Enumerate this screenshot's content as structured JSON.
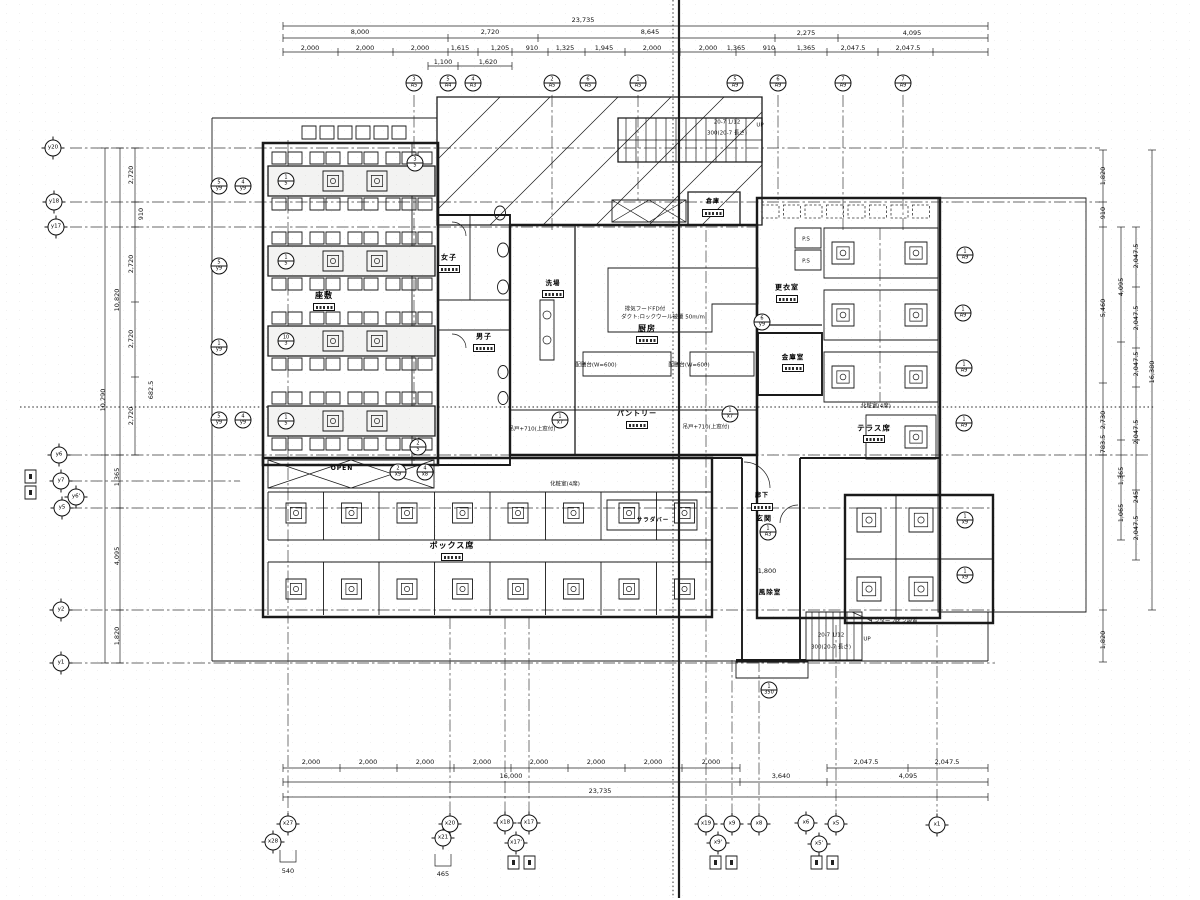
{
  "page": {
    "background": "#ffffff",
    "ink": "#1a1a1a"
  },
  "dimensions": {
    "top": [
      {
        "x": 583,
        "y": 20,
        "t": "23,735"
      },
      {
        "x": 360,
        "y": 32,
        "t": "8,000"
      },
      {
        "x": 490,
        "y": 32,
        "t": "2,720"
      },
      {
        "x": 650,
        "y": 32,
        "t": "8,645"
      },
      {
        "x": 806,
        "y": 33,
        "t": "2,275"
      },
      {
        "x": 912,
        "y": 33,
        "t": "4,095"
      },
      {
        "x": 310,
        "y": 48,
        "t": "2,000"
      },
      {
        "x": 365,
        "y": 48,
        "t": "2,000"
      },
      {
        "x": 420,
        "y": 48,
        "t": "2,000"
      },
      {
        "x": 460,
        "y": 48,
        "t": "1,615"
      },
      {
        "x": 500,
        "y": 48,
        "t": "1,205"
      },
      {
        "x": 532,
        "y": 48,
        "t": "910"
      },
      {
        "x": 565,
        "y": 48,
        "t": "1,325"
      },
      {
        "x": 604,
        "y": 48,
        "t": "1,945"
      },
      {
        "x": 652,
        "y": 48,
        "t": "2,000"
      },
      {
        "x": 708,
        "y": 48,
        "t": "2,000"
      },
      {
        "x": 736,
        "y": 48,
        "t": "1,365"
      },
      {
        "x": 769,
        "y": 48,
        "t": "910"
      },
      {
        "x": 806,
        "y": 48,
        "t": "1,365"
      },
      {
        "x": 853,
        "y": 48,
        "t": "2,047.5"
      },
      {
        "x": 908,
        "y": 48,
        "t": "2,047.5"
      },
      {
        "x": 443,
        "y": 62,
        "t": "1,100"
      },
      {
        "x": 488,
        "y": 62,
        "t": "1,620"
      }
    ],
    "bottom": [
      {
        "x": 311,
        "y": 762,
        "t": "2,000"
      },
      {
        "x": 368,
        "y": 762,
        "t": "2,000"
      },
      {
        "x": 425,
        "y": 762,
        "t": "2,000"
      },
      {
        "x": 482,
        "y": 762,
        "t": "2,000"
      },
      {
        "x": 539,
        "y": 762,
        "t": "2,000"
      },
      {
        "x": 596,
        "y": 762,
        "t": "2,000"
      },
      {
        "x": 653,
        "y": 762,
        "t": "2,000"
      },
      {
        "x": 711,
        "y": 762,
        "t": "2,000"
      },
      {
        "x": 866,
        "y": 762,
        "t": "2,047.5"
      },
      {
        "x": 947,
        "y": 762,
        "t": "2,047.5"
      },
      {
        "x": 511,
        "y": 776,
        "t": "16,000"
      },
      {
        "x": 781,
        "y": 776,
        "t": "3,640"
      },
      {
        "x": 908,
        "y": 776,
        "t": "4,095"
      },
      {
        "x": 600,
        "y": 791,
        "t": "23,735"
      }
    ],
    "left": [
      {
        "x": 131,
        "y": 175,
        "t": "2,720",
        "r": 1
      },
      {
        "x": 141,
        "y": 214,
        "t": "910",
        "r": 1
      },
      {
        "x": 131,
        "y": 264,
        "t": "2,720",
        "r": 1
      },
      {
        "x": 131,
        "y": 339,
        "t": "2,720",
        "r": 1
      },
      {
        "x": 131,
        "y": 416,
        "t": "2,720",
        "r": 1
      },
      {
        "x": 117,
        "y": 300,
        "t": "10,820",
        "r": 1
      },
      {
        "x": 103,
        "y": 400,
        "t": "10,290",
        "r": 1
      },
      {
        "x": 151,
        "y": 390,
        "t": "682.5",
        "r": 1
      },
      {
        "x": 117,
        "y": 477,
        "t": "1,365",
        "r": 1
      },
      {
        "x": 117,
        "y": 556,
        "t": "4,095",
        "r": 1
      },
      {
        "x": 117,
        "y": 636,
        "t": "1,820",
        "r": 1
      }
    ],
    "right": [
      {
        "x": 1103,
        "y": 176,
        "t": "1,820",
        "r": 1
      },
      {
        "x": 1103,
        "y": 213,
        "t": "910",
        "r": 1
      },
      {
        "x": 1103,
        "y": 308,
        "t": "5,460",
        "r": 1
      },
      {
        "x": 1103,
        "y": 420,
        "t": "2,730",
        "r": 1
      },
      {
        "x": 1121,
        "y": 287,
        "t": "4,095",
        "r": 1
      },
      {
        "x": 1136,
        "y": 256,
        "t": "2,047.5",
        "r": 1
      },
      {
        "x": 1136,
        "y": 318,
        "t": "2,047.5",
        "r": 1
      },
      {
        "x": 1136,
        "y": 364,
        "t": "2,047.5",
        "r": 1
      },
      {
        "x": 1152,
        "y": 372,
        "t": "16,380",
        "r": 1
      },
      {
        "x": 1103,
        "y": 444,
        "t": "783.5",
        "r": 1
      },
      {
        "x": 1136,
        "y": 432,
        "t": "2,047.5",
        "r": 1
      },
      {
        "x": 1121,
        "y": 476,
        "t": "1,365",
        "r": 1
      },
      {
        "x": 1136,
        "y": 497,
        "t": "245",
        "r": 1
      },
      {
        "x": 1121,
        "y": 513,
        "t": "1,065",
        "r": 1
      },
      {
        "x": 1136,
        "y": 528,
        "t": "2,047.5",
        "r": 1
      },
      {
        "x": 1103,
        "y": 640,
        "t": "1,820",
        "r": 1
      }
    ],
    "misc": [
      {
        "x": 767,
        "y": 571,
        "t": "1,800"
      },
      {
        "x": 288,
        "y": 871,
        "t": "540"
      },
      {
        "x": 443,
        "y": 874,
        "t": "465"
      }
    ]
  },
  "grid_bubbles": {
    "axis": [
      {
        "x": 273,
        "y": 842,
        "t": "x28"
      },
      {
        "x": 288,
        "y": 824,
        "t": "x27"
      },
      {
        "x": 443,
        "y": 838,
        "t": "x21"
      },
      {
        "x": 450,
        "y": 824,
        "t": "x20"
      },
      {
        "x": 505,
        "y": 823,
        "t": "x18"
      },
      {
        "x": 529,
        "y": 823,
        "t": "x17"
      },
      {
        "x": 516,
        "y": 843,
        "t": "x17'"
      },
      {
        "x": 706,
        "y": 824,
        "t": "x19"
      },
      {
        "x": 732,
        "y": 824,
        "t": "x9"
      },
      {
        "x": 759,
        "y": 824,
        "t": "x8"
      },
      {
        "x": 718,
        "y": 843,
        "t": "x9'"
      },
      {
        "x": 806,
        "y": 823,
        "t": "x6"
      },
      {
        "x": 836,
        "y": 824,
        "t": "x5"
      },
      {
        "x": 819,
        "y": 844,
        "t": "x5'"
      },
      {
        "x": 937,
        "y": 825,
        "t": "x1"
      },
      {
        "x": 53,
        "y": 148,
        "t": "y20"
      },
      {
        "x": 54,
        "y": 202,
        "t": "y18"
      },
      {
        "x": 56,
        "y": 227,
        "t": "y17"
      },
      {
        "x": 59,
        "y": 455,
        "t": "y6"
      },
      {
        "x": 61,
        "y": 481,
        "t": "y7"
      },
      {
        "x": 76,
        "y": 497,
        "t": "y6'"
      },
      {
        "x": 62,
        "y": 508,
        "t": "y5"
      },
      {
        "x": 61,
        "y": 610,
        "t": "y2"
      },
      {
        "x": 61,
        "y": 663,
        "t": "y1"
      }
    ],
    "reference": [
      {
        "x": 414,
        "y": 83,
        "t": "3",
        "b": "A5"
      },
      {
        "x": 448,
        "y": 83,
        "t": "5",
        "b": "A4"
      },
      {
        "x": 473,
        "y": 83,
        "t": "4",
        "b": "A3"
      },
      {
        "x": 552,
        "y": 83,
        "t": "2",
        "b": "A5"
      },
      {
        "x": 588,
        "y": 83,
        "t": "6",
        "b": "A5"
      },
      {
        "x": 638,
        "y": 83,
        "t": "1",
        "b": "A5"
      },
      {
        "x": 735,
        "y": 83,
        "t": "5",
        "b": "A9"
      },
      {
        "x": 778,
        "y": 83,
        "t": "6",
        "b": "A9"
      },
      {
        "x": 843,
        "y": 83,
        "t": "7",
        "b": "A9"
      },
      {
        "x": 903,
        "y": 83,
        "t": "7",
        "b": "A9"
      },
      {
        "x": 286,
        "y": 181,
        "t": "1",
        "b": "5"
      },
      {
        "x": 286,
        "y": 261,
        "t": "1",
        "b": "5"
      },
      {
        "x": 286,
        "y": 341,
        "t": "10",
        "b": "3"
      },
      {
        "x": 286,
        "y": 421,
        "t": "1",
        "b": "5"
      },
      {
        "x": 415,
        "y": 163,
        "t": "3",
        "b": "5"
      },
      {
        "x": 418,
        "y": 447,
        "t": "2",
        "b": "5"
      },
      {
        "x": 398,
        "y": 472,
        "t": "2",
        "b": "x9"
      },
      {
        "x": 425,
        "y": 472,
        "t": "4",
        "b": "x8"
      },
      {
        "x": 768,
        "y": 532,
        "t": "1",
        "b": "A3"
      },
      {
        "x": 769,
        "y": 690,
        "t": "1",
        "b": "350"
      },
      {
        "x": 965,
        "y": 255,
        "t": "1",
        "b": "A9"
      },
      {
        "x": 963,
        "y": 313,
        "t": "1",
        "b": "A9"
      },
      {
        "x": 964,
        "y": 368,
        "t": "1",
        "b": "A9"
      },
      {
        "x": 964,
        "y": 423,
        "t": "1",
        "b": "A9"
      },
      {
        "x": 965,
        "y": 520,
        "t": "1",
        "b": "x9"
      },
      {
        "x": 965,
        "y": 575,
        "t": "1",
        "b": "x9"
      },
      {
        "x": 730,
        "y": 414,
        "t": "1",
        "b": "x7"
      },
      {
        "x": 560,
        "y": 420,
        "t": "1",
        "b": "x7"
      },
      {
        "x": 762,
        "y": 322,
        "t": "6",
        "b": "y9"
      },
      {
        "x": 219,
        "y": 186,
        "t": "5",
        "b": "y9"
      },
      {
        "x": 243,
        "y": 186,
        "t": "4",
        "b": "y9"
      },
      {
        "x": 219,
        "y": 266,
        "t": "5",
        "b": "y9"
      },
      {
        "x": 219,
        "y": 347,
        "t": "1",
        "b": "y9"
      },
      {
        "x": 219,
        "y": 420,
        "t": "5",
        "b": "y9"
      },
      {
        "x": 243,
        "y": 420,
        "t": "4",
        "b": "y9"
      }
    ]
  },
  "rooms": [
    {
      "x": 324,
      "y": 296,
      "t": "座敷",
      "s": 8,
      "g": 1
    },
    {
      "x": 449,
      "y": 258,
      "t": "女子",
      "s": 7,
      "g": 1
    },
    {
      "x": 484,
      "y": 337,
      "t": "男子",
      "s": 7,
      "g": 1
    },
    {
      "x": 553,
      "y": 283,
      "t": "洗場",
      "s": 6.5,
      "g": 1
    },
    {
      "x": 647,
      "y": 329,
      "t": "厨房",
      "s": 8,
      "g": 1
    },
    {
      "x": 637,
      "y": 414,
      "t": "パントリー",
      "s": 7,
      "g": 1
    },
    {
      "x": 787,
      "y": 288,
      "t": "更衣室",
      "s": 7,
      "g": 1
    },
    {
      "x": 793,
      "y": 357,
      "t": "金庫室",
      "s": 6.5,
      "g": 1
    },
    {
      "x": 874,
      "y": 428,
      "t": "テラス席",
      "s": 7.5,
      "g": 1
    },
    {
      "x": 452,
      "y": 546,
      "t": "ボックス席",
      "s": 8,
      "g": 1
    },
    {
      "x": 764,
      "y": 519,
      "t": "玄関",
      "s": 7
    },
    {
      "x": 770,
      "y": 592,
      "t": "風除室",
      "s": 6.5
    },
    {
      "x": 762,
      "y": 496,
      "t": "廊下",
      "s": 6,
      "g": 1
    },
    {
      "x": 713,
      "y": 202,
      "t": "倉庫",
      "s": 6,
      "g": 1
    },
    {
      "x": 653,
      "y": 521,
      "t": "サラダバー",
      "s": 5.5
    },
    {
      "x": 342,
      "y": 469,
      "t": "OPEN",
      "s": 6
    }
  ],
  "notes": [
    {
      "x": 645,
      "y": 310,
      "t": "排気フードFD付"
    },
    {
      "x": 663,
      "y": 318,
      "t": "ダクト:ロックウール被覆 50m/m"
    },
    {
      "x": 876,
      "y": 407,
      "t": "化粧室(4席)"
    },
    {
      "x": 565,
      "y": 485,
      "t": "化粧室(4席)"
    },
    {
      "x": 806,
      "y": 240,
      "t": "P.S"
    },
    {
      "x": 806,
      "y": 262,
      "t": "P.S"
    },
    {
      "x": 893,
      "y": 622,
      "t": "インターフォン設置"
    },
    {
      "x": 596,
      "y": 366,
      "t": "配膳台(W=600)"
    },
    {
      "x": 689,
      "y": 366,
      "t": "配膳台(W=600)"
    },
    {
      "x": 532,
      "y": 430,
      "t": "吊戸+710(上窓付)"
    },
    {
      "x": 706,
      "y": 428,
      "t": "吊戸+710(上窓付)"
    },
    {
      "x": 727,
      "y": 123,
      "t": "20-7 1/12"
    },
    {
      "x": 727,
      "y": 134,
      "t": "300(20-7 長さ)"
    },
    {
      "x": 760,
      "y": 126,
      "t": "UP"
    },
    {
      "x": 831,
      "y": 636,
      "t": "20-7 1/12"
    },
    {
      "x": 831,
      "y": 648,
      "t": "300(20-7 長さ)"
    },
    {
      "x": 867,
      "y": 640,
      "t": "UP"
    }
  ]
}
